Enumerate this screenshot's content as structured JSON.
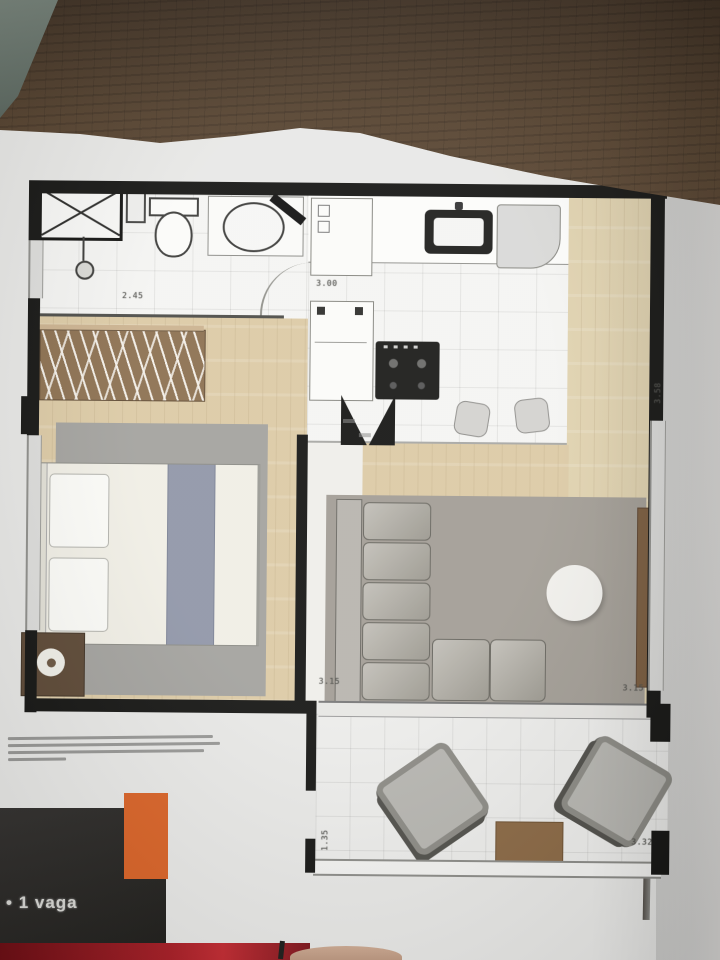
{
  "photo": {
    "table_wood_color": "#55422f",
    "corner_object_color": "#5e6a62",
    "page_color": "#e8e8e6",
    "red_book_color": "#a81e26",
    "finger_color": "#c7a28b"
  },
  "floor_plan": {
    "wall_color": "#161614",
    "wood_floor_color": "#dccaa5",
    "tile_color": "#f4f4f2",
    "rug_color": "#a29d95",
    "wardrobe_color": "#8c7050",
    "sofa_color": "#b2afa8",
    "bed_blanket_color": "#9096a8",
    "sideboard_color": "#7a5c3e",
    "balcony_table_color": "#8a6844",
    "dimensions": {
      "bathroom_width": "2.45",
      "kitchen_length": "3.00",
      "living_width_left": "3.15",
      "living_width_right": "3.15",
      "balcony_depth": "1.35",
      "balcony_width": "3.32",
      "right_wall": "3.58"
    }
  },
  "footer": {
    "bullet": "•",
    "parking_label": "1 vaga",
    "orange_accent": "#d96327",
    "panel_color": "#2e2c29"
  }
}
